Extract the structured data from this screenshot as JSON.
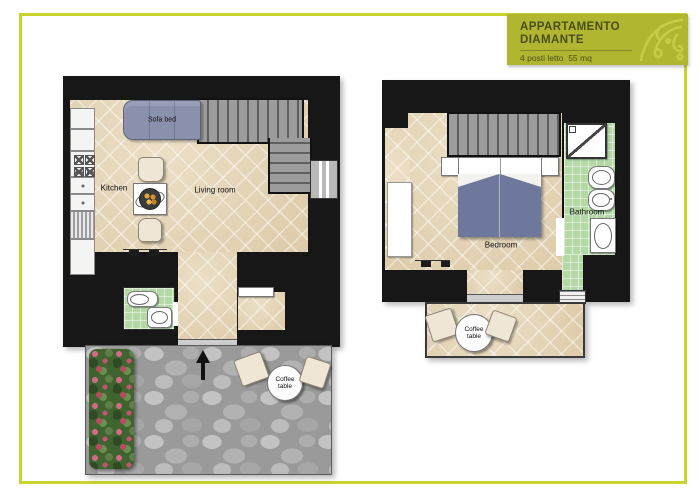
{
  "header": {
    "title_line1": "APPARTAMENTO",
    "title_line2": "DIAMANTE",
    "subtitle": "4 posti letto  55 mq"
  },
  "ground_floor": {
    "sofa_label": "Sofa bed",
    "kitchen_label": "Kitchen",
    "living_room_label": "Living room",
    "coffee_table_label": [
      "Coffee",
      "table"
    ]
  },
  "upper_floor": {
    "bedroom_label": "Bedroom",
    "bathroom_label": "Bathroom",
    "coffee_table_label": [
      "Coffee",
      "table"
    ]
  },
  "icons": {
    "header_ornament": "floral-corner-ornament",
    "entrance_arrow": "up-arrow"
  },
  "colors": {
    "frame": "#c9d32e",
    "header_bg": "#b1b631",
    "header_text": "#4c4c1c",
    "wall": "#171717",
    "floor_tile": "#e7d9bf",
    "bathroom_tile": "#b5d9a6",
    "sofa_bed": "#8a91ad",
    "bed_blanket": "#6e789c",
    "terrace_stone": "#9a9a9a",
    "stairs": "#9c9c9c"
  }
}
